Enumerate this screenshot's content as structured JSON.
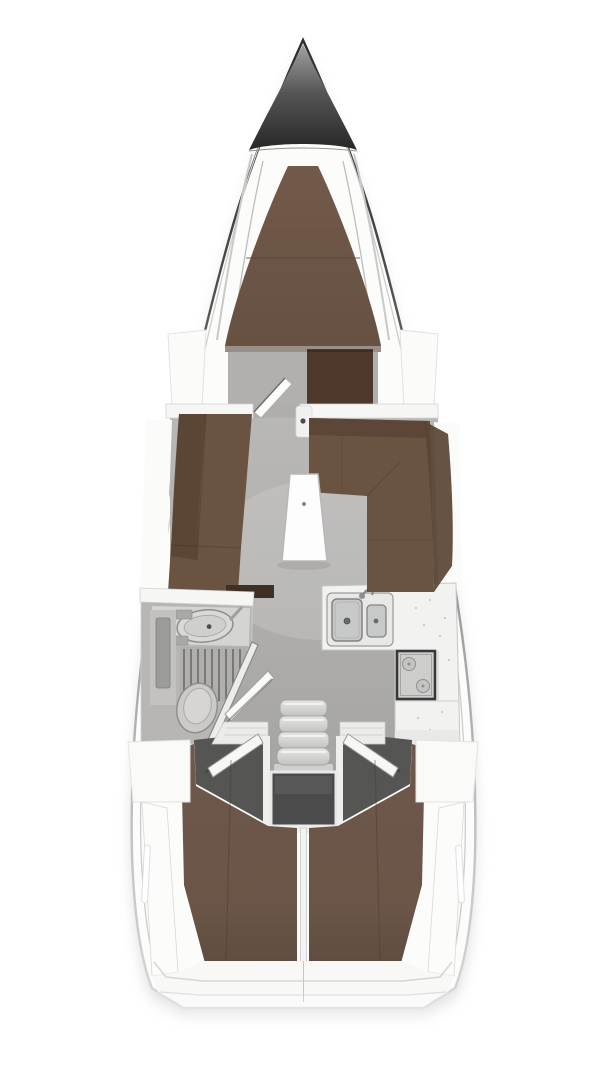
{
  "diagram": {
    "title": "sailing-yacht-interior-floor-plan-top-view",
    "type": "boat-layout-rendering"
  },
  "colors": {
    "page_bg": "#ffffff",
    "hull_fill": "#fcfcfb",
    "hull_line_dark": "#3f3f3f",
    "bow_top": "#a3a3a3",
    "bow_mid": "#555555",
    "bow_bottom": "#262626",
    "floor_gray": "#b5b4b2",
    "floor_dark": "#a8a7a5",
    "v_berth_brown": "#6f5848",
    "settee_brown": "#6b5341",
    "backrest_brown": "#5a4434",
    "wardrobe_brown": "#4e392c",
    "cabinet_dark_brown": "#3f2f24",
    "aft_berth_brown": "#6b5649",
    "entry_floor_dark": "#555554",
    "engine_box_gray": "#4b4b4b",
    "counter_white": "#f2f2f1",
    "sink_gray": "#c7c9c9",
    "fixture_gray": "#cbcac9",
    "fixture_line_gray": "#8e8e8e",
    "stove_frame_dark": "#383838",
    "step_top": "#e6e6e5",
    "step_bottom": "#c3c3c2",
    "table_white": "#fdfdfd",
    "white_panel": "#fbfbfa",
    "shelf_white": "#ebebea",
    "stern_floor_white": "#f8f8f7",
    "divider_white": "#f3f3f2",
    "shadow_gray": "#b7b7b7"
  },
  "areas": {
    "bow_anchor_locker": "anchor locker",
    "forward_v_berth": "forward cabin double berth",
    "forward_cabin_floor": "forward cabin",
    "wardrobe": "wardrobe",
    "forward_cabin_door": "forward cabin door (open)",
    "saloon": "saloon",
    "port_settee": "port settee",
    "starboard_settee": "L-shaped starboard settee",
    "saloon_table": "saloon table",
    "wet_room": "wet room / head",
    "wash_basin": "wash basin",
    "shower_grate": "shower floor grate",
    "toilet": "toilet",
    "wet_room_door": "wet room door (open)",
    "galley": "galley",
    "galley_sinks": "double galley sink",
    "stove": "stove / hob",
    "companionway_steps": "companionway steps",
    "engine_compartment": "engine compartment",
    "port_aft_cabin": "port aft cabin berth",
    "starboard_aft_cabin": "starboard aft cabin berth",
    "aft_cabin_doors": "aft cabin doors (open)",
    "stern_platform": "stern"
  }
}
